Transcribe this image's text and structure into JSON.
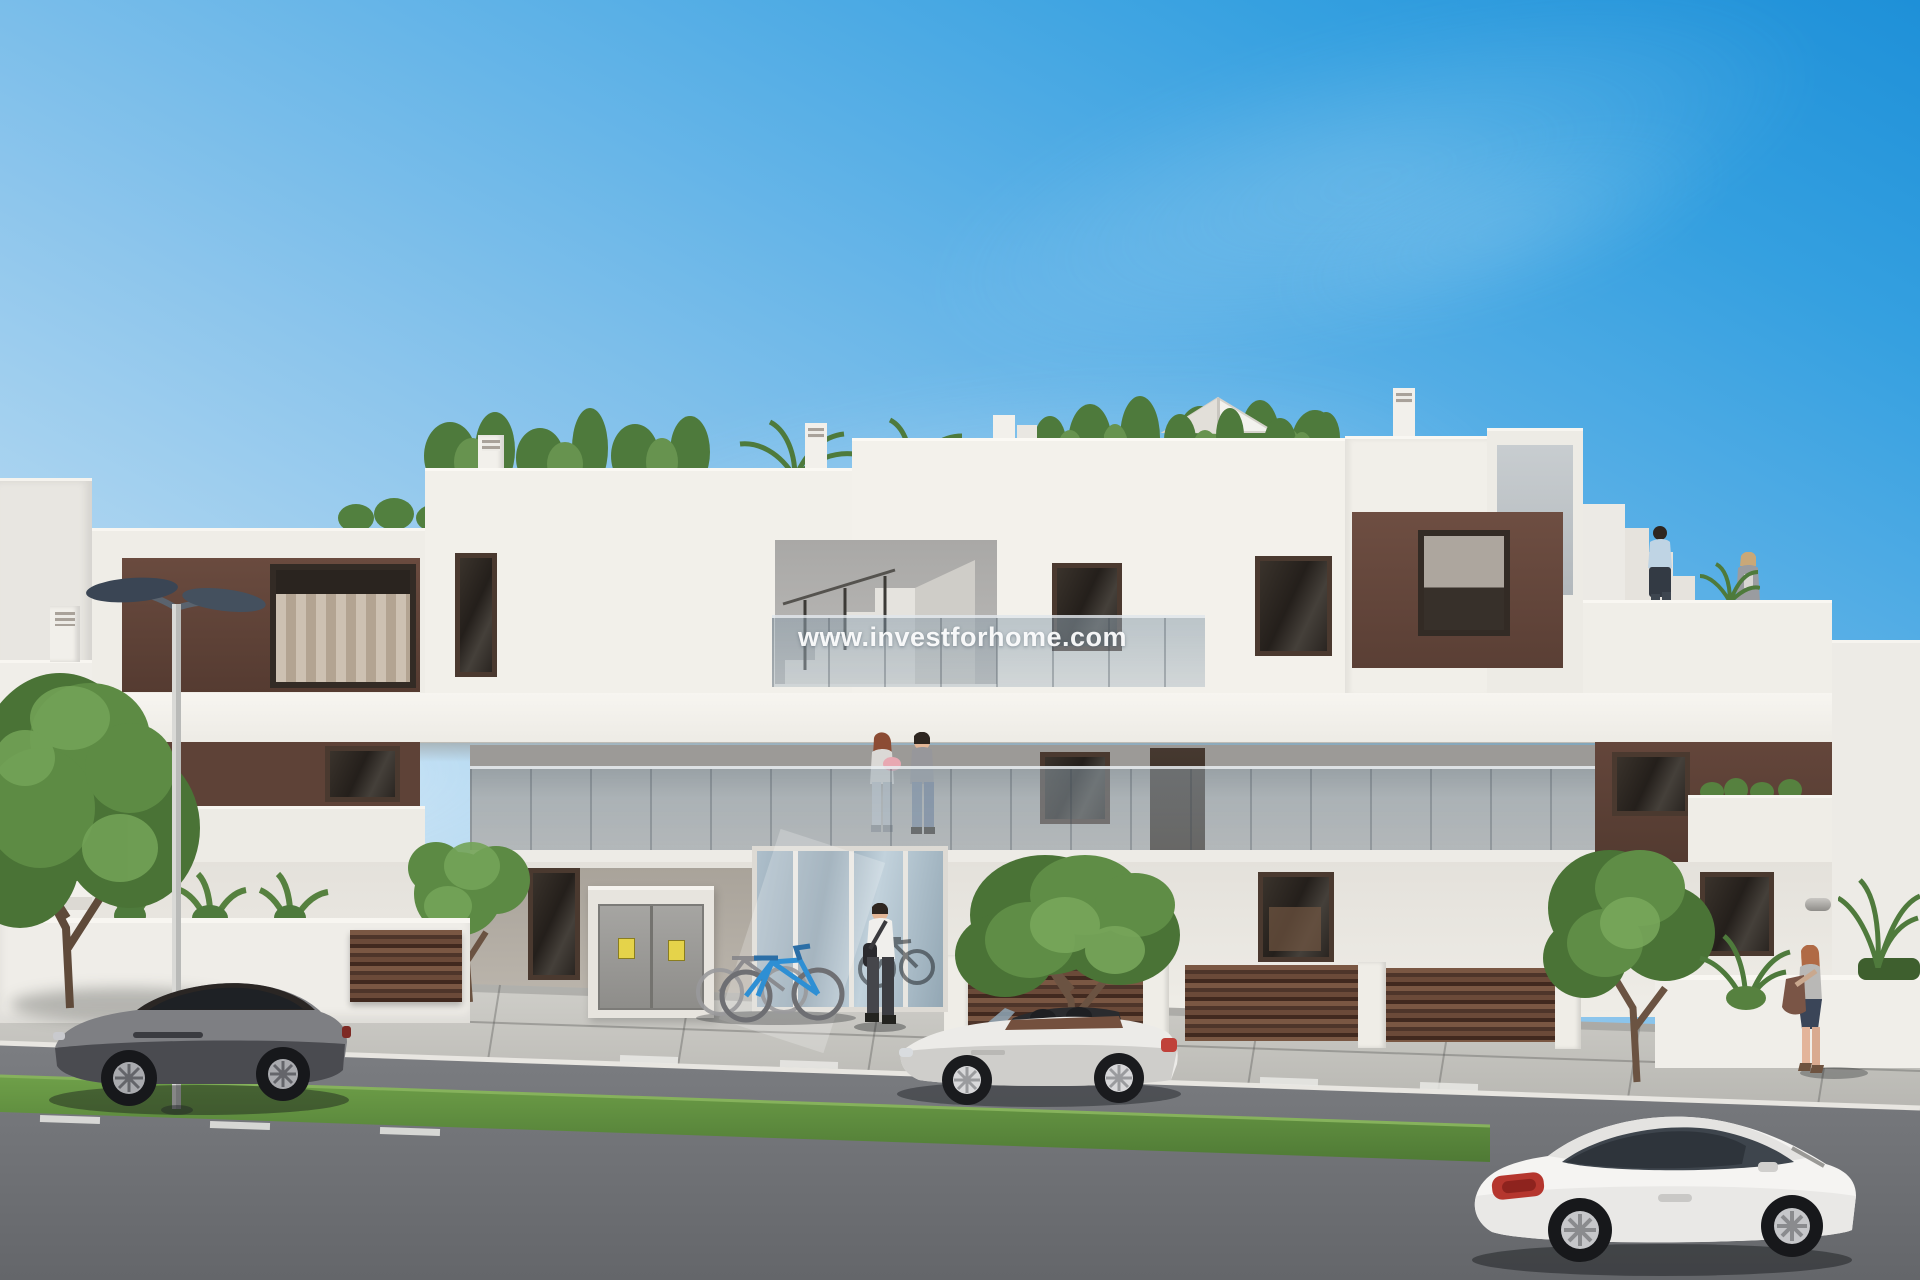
{
  "watermark": {
    "text": "www.investforhome.com"
  },
  "palette": {
    "sky_top": "#2B9CE0",
    "sky_horizon": "#E4F0F8",
    "facade_white": "#F1EFEA",
    "facade_shade": "#DEDBD6",
    "accent_brown": "#5E4237",
    "window_dark": "#2E2823",
    "glass_balustrade": "#9FB2BD",
    "grass": "#5F8F3F",
    "asphalt": "#74777B",
    "sidewalk": "#C9C8C3",
    "car_left_grey": "#77777B",
    "car_center_silver": "#E9E8E5",
    "car_right_white": "#F2F1EF",
    "tail_light_red": "#B23A33",
    "bicycle_blue": "#2E8FD4",
    "warning_sticker_yellow": "#E5D34A",
    "street_lamp_head": "#3E4A5A"
  },
  "scene": {
    "objects": [
      "apartment-building",
      "roof-garden",
      "glass-balustrades",
      "street-lamp",
      "grey-coupe-car",
      "silver-convertible-car",
      "white-coupe-car",
      "bicycles",
      "entrance-man",
      "balcony-couple",
      "roof-terrace-man",
      "roof-terrace-woman",
      "sidewalk-woman",
      "trees",
      "brown-slat-fences",
      "utility-cabinet",
      "road",
      "sidewalk",
      "grass-verge"
    ]
  }
}
